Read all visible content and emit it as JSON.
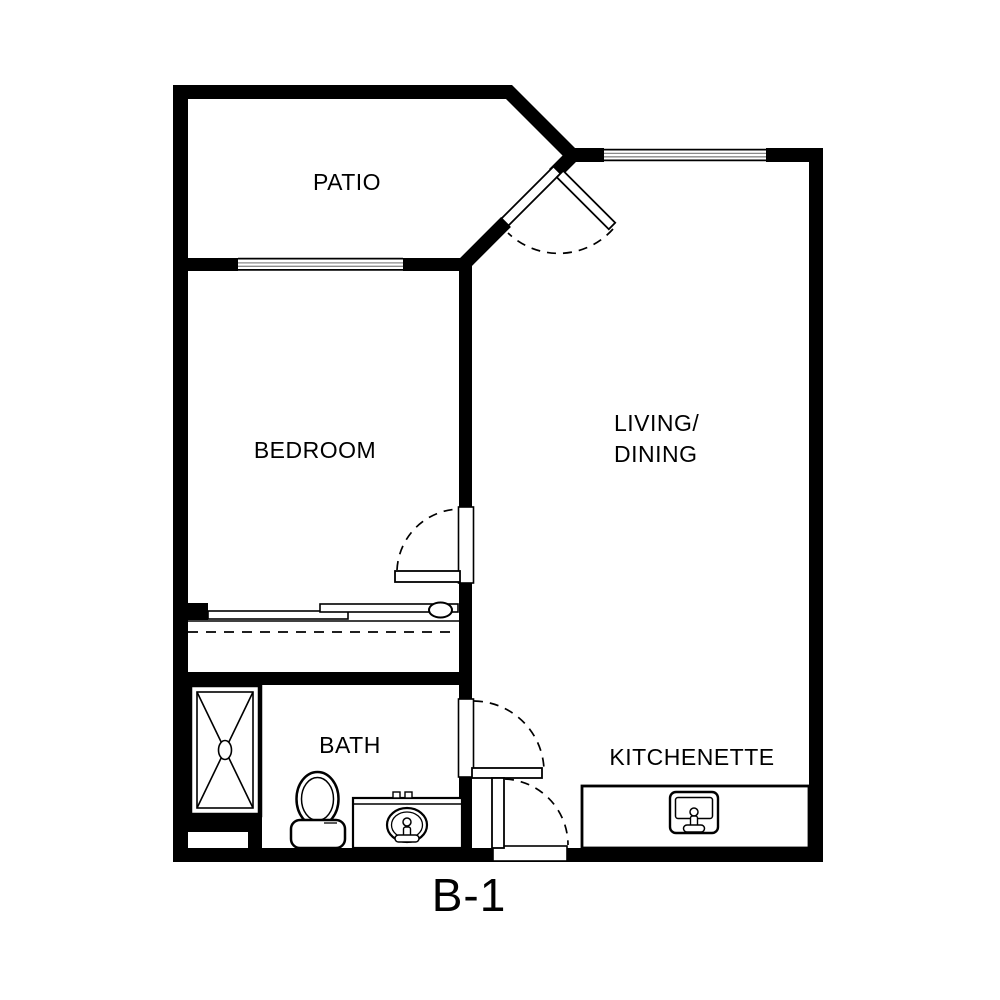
{
  "plan": {
    "title": "B-1"
  },
  "rooms": {
    "patio": {
      "label": "PATIO"
    },
    "bedroom": {
      "label": "BEDROOM"
    },
    "living_dining": {
      "line1": "LIVING/",
      "line2": "DINING"
    },
    "bath": {
      "label": "BATH"
    },
    "kitchenette": {
      "label": "KITCHENETTE"
    }
  },
  "fixtures": {
    "shower": "shower-pan-with-x",
    "toilet": "toilet",
    "vanity": "vanity-with-oval-sink",
    "kitchen_counter": "kitchenette-counter",
    "kitchen_sink": "kitchen-sink",
    "closet": "sliding-door-closet-with-rod"
  },
  "openings": {
    "patio_door": "hinged-door-swing",
    "bedroom_door": "hinged-door-swing",
    "bath_door": "hinged-door-swing",
    "entry_door": "hinged-door-swing",
    "patio_window": "window",
    "living_window": "window"
  },
  "colors": {
    "wall": "#000000",
    "background": "#ffffff",
    "window_pane_line": "#8a8a8a"
  }
}
